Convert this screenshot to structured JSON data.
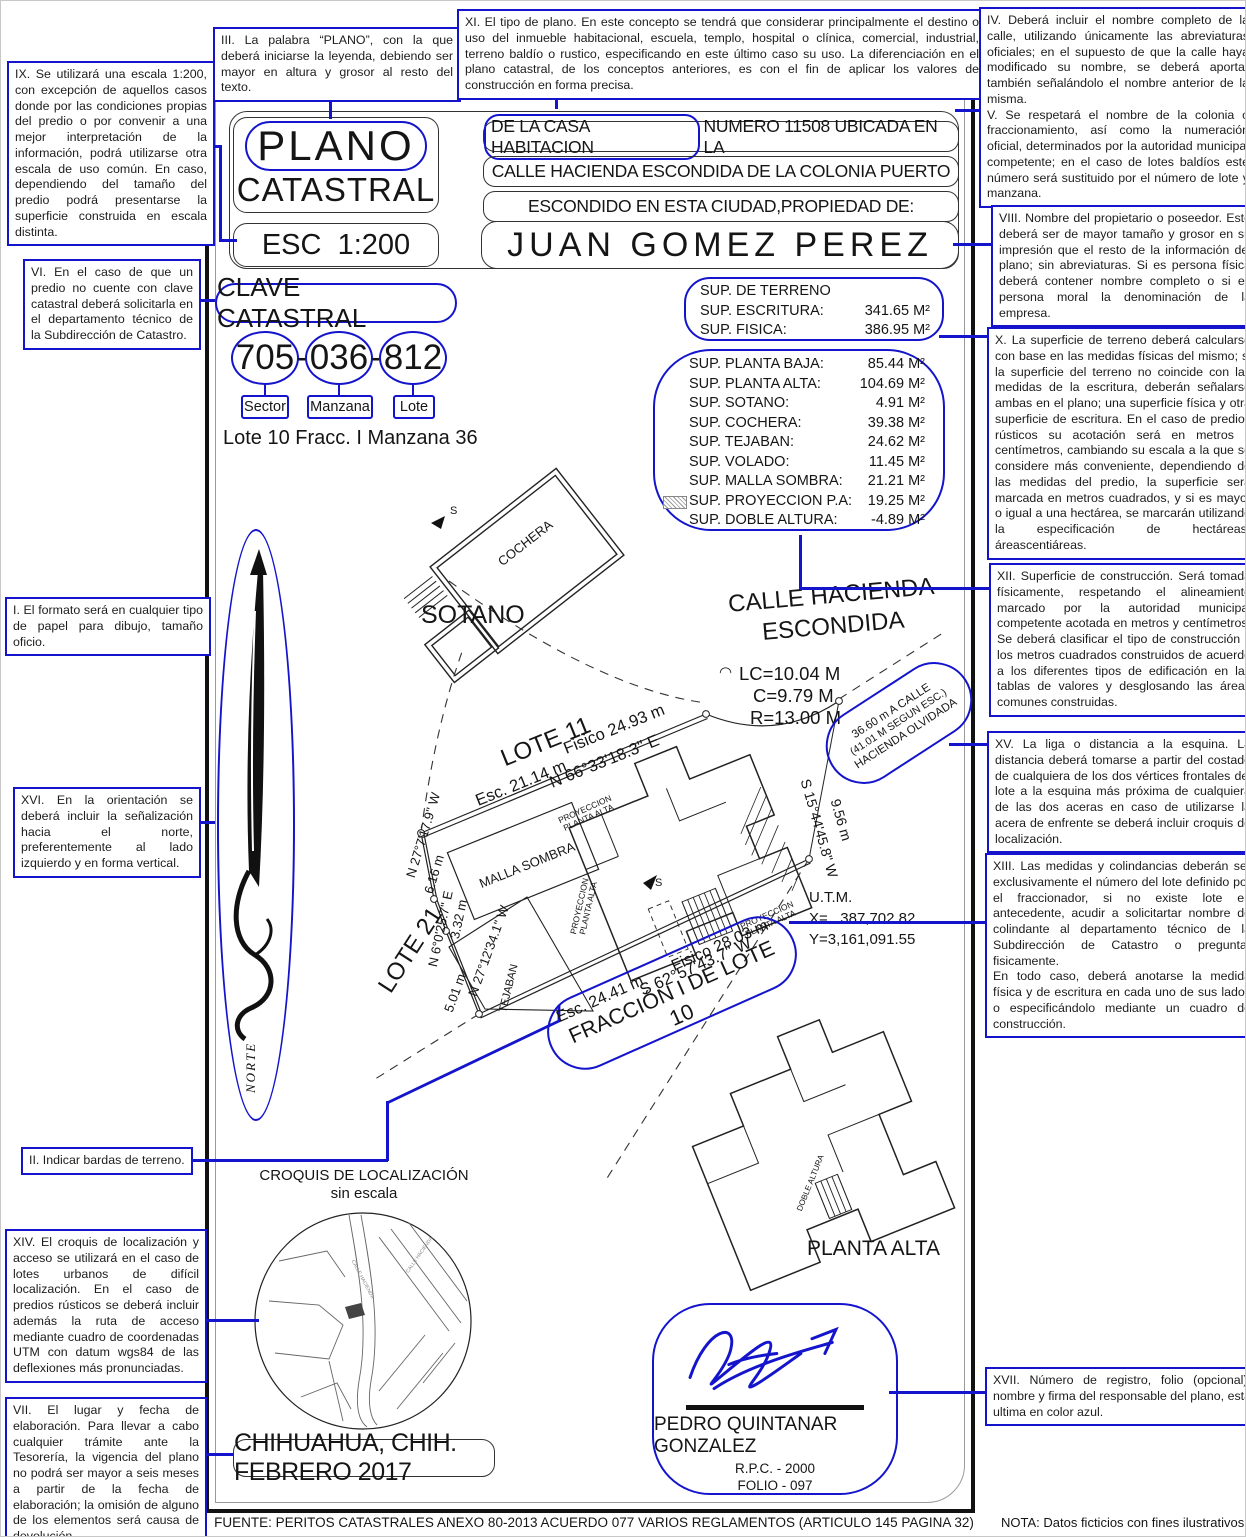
{
  "colors": {
    "annotation_blue": "#1414cc",
    "ink": "#151515"
  },
  "annotations": {
    "ix": "IX. Se utilizará una escala 1:200, con excepción de aquellos casos donde por las condiciones propias del predio o por convenir a una mejor interpretación de la información, podrá utilizarse otra escala de uso común. En caso, dependiendo del tamaño del predio podrá presentarse la superficie construida en escala distinta.",
    "iii": "III. La palabra “PLANO”, con la que deberá iniciarse la leyenda, debiendo ser mayor en altura y grosor al resto del texto.",
    "xi": "XI. El tipo de plano. En este concepto se tendrá que considerar principalmente el destino o uso del inmueble habitacional, escuela, templo, hospital o clínica, comercial, industrial, terreno baldío o rustico, especificando en este último caso su uso. La diferenciación en el plano catastral, de los conceptos anteriores, es con el fin de aplicar los valores de construcción en forma precisa.",
    "iv": "IV. Deberá incluir el nombre completo de la calle, utilizando únicamente las abreviaturas oficiales; en el supuesto de que la calle haya modificado su nombre, se deberá aportar también señalándolo el nombre anterior de la misma.",
    "v": "V. Se respetará el nombre de la colonia o fraccionamiento, así como la numeración oficial, determinados por la autoridad municipal competente; en el caso de lotes baldíos este número será sustituido por el número de lote y manzana.",
    "viii": "VIII. Nombre del propietario o poseedor. Este deberá ser de mayor tamaño y grosor en su impresión que el resto de la información del plano; sin abreviaturas. Si es persona física deberá contener nombre completo o si es persona moral la denominación de la empresa.",
    "x": "X. La superficie de terreno deberá calcularse con base en las medidas físicas del mismo; si la superficie del terreno no coincide con las medidas de la escritura, deberán señalarse ambas en el plano; una superficie física y otra superficie de escritura. En el caso de predios rústicos su acotación será en metros y centímetros, cambiando su escala a la que se considere más conveniente, dependiendo de las medidas del predio, la superficie será marcada en metros cuadrados, y si es mayor o igual a una hectárea, se marcarán utilizando la especificación de hectáreas-áreascentiáreas.",
    "xii": "XII. Superficie de construcción. Será tomada físicamente, respetando el alineamiento marcado por la autoridad municipal competente acotada en metros y centímetros. Se deberá clasificar el tipo de construcción y los metros cuadrados construidos de acuerdo a los diferentes tipos de edificación en las tablas de valores y desglosando las áreas comunes construidas.",
    "xv": "XV. La liga o distancia a la esquina. La distancia deberá tomarse a partir del costado de cualquiera de los dos vértices frontales del lote a la esquina más próxima de cualquiera de las dos aceras en caso de utilizarse la acera de enfrente se deberá incluir croquis de localización.",
    "xiii_p1": "XIII. Las medidas y colindancias deberán ser exclusivamente el número del lote definido por el fraccionador, si no existe lote en antecedente, acudir a solicitartar nombre de colindante al departamento técnico de la Subdirección de Catastro o preguntar fisicamente.",
    "xiii_p2": "En todo caso, deberá anotarse la medida física y de escritura en cada uno de sus lados o especificándolo mediante un cuadro de construcción.",
    "xvii": "XVII. Número de registro, folio (opcional), nombre y firma del responsable del plano, esta ultima en color azul.",
    "vi": "VI. En el caso de que un predio no cuente con clave catastral deberá solicitarla en el departamento técnico de la Subdirección de Catastro.",
    "i": "I. El formato será en cualquier tipo de papel para dibujo, tamaño oficio.",
    "xvi": "XVI. En la orientación se deberá incluir la señalización hacia el norte, preferentemente al lado izquierdo y en forma vertical.",
    "ii": "II. Indicar bardas de terreno.",
    "xiv": "XIV. El croquis de localización y acceso se utilizará en el caso de lotes urbanos de difícil localización. En el caso de predios rústicos se deberá incluir además la ruta de acceso mediante cuadro de coordenadas UTM con datum wgs84 de las deflexiones más pronunciadas.",
    "vii": "VII. El lugar y fecha de elaboración. Para llevar a cabo cualquier trámite ante la Tesorería, la vigencia del plano no podrá ser mayor a seis meses a partir de la fecha de elaboración; la omisión de alguno de los elementos será causa de devolución."
  },
  "title_block": {
    "plano": "PLANO",
    "catastral": "CATASTRAL",
    "esc": "ESC  1:200",
    "owner": "JUAN GOMEZ PEREZ",
    "addr1_hl": "DE LA CASA HABITACION",
    "addr1_rest": "NUMERO 11508 UBICADA EN LA",
    "addr2": "CALLE HACIENDA ESCONDIDA DE LA COLONIA PUERTO",
    "addr3": "ESCONDIDO EN ESTA CIUDAD,PROPIEDAD DE:"
  },
  "clave": {
    "title": "CLAVE CATASTRAL",
    "sector_num": "705",
    "manzana_num": "036",
    "lote_num": "812",
    "dash": "-",
    "sector_label": "Sector",
    "manzana_label": "Manzana",
    "lote_label": "Lote",
    "sub": "Lote 10 Fracc. I Manzana 36"
  },
  "sup_terreno": {
    "title": "SUP. DE TERRENO",
    "rows": [
      {
        "label": "SUP. ESCRITURA:",
        "value": "341.65 M²"
      },
      {
        "label": "SUP. FISICA:",
        "value": "386.95 M²"
      }
    ]
  },
  "sup_construccion": {
    "rows": [
      {
        "label": "SUP. PLANTA BAJA:",
        "value": "85.44 M²"
      },
      {
        "label": "SUP. PLANTA ALTA:",
        "value": "104.69 M²"
      },
      {
        "label": "SUP. SOTANO:",
        "value": "4.91 M²"
      },
      {
        "label": "SUP. COCHERA:",
        "value": "39.38 M²"
      },
      {
        "label": "SUP. TEJABAN:",
        "value": "24.62 M²"
      },
      {
        "label": "SUP. VOLADO:",
        "value": "11.45 M²"
      },
      {
        "label": "SUP. MALLA SOMBRA:",
        "value": "21.21 M²"
      },
      {
        "label": "SUP. PROYECCION P.A:",
        "value": "19.25 M²"
      },
      {
        "label": "SUP. DOBLE ALTURA:",
        "value": "-4.89 M²"
      }
    ]
  },
  "plan": {
    "sotano": "SOTANO",
    "cochera": "COCHERA",
    "calle1": "CALLE HACIENDA",
    "calle2": "ESCONDIDA",
    "arc_glyph": "◠",
    "lc": "LC=10.04 M",
    "c": "C=9.79 M",
    "r": "R=13.00 M",
    "lote11": "LOTE 11",
    "esc_n": "Esc. 21.14 m",
    "fisico_n": "Fisico 24.93 m",
    "bearing_n": "N 66°33'18.3\" E",
    "b1": "N 27°7'17.9\" W",
    "d1": "6.16 m",
    "b2": "N 6°0'25.7\" E",
    "d2": "3.32 m",
    "b3": "N 27°12'34.1\" W",
    "d3": "5.01 m",
    "lote21": "LOTE 21",
    "malla_sombra": "MALLA SOMBRA",
    "tejaban": "TEJABAN",
    "proyeccion1": "PROYECCION",
    "proyeccion2": "PLANTA ALTA",
    "bearing_s": "S 62°57'43.7\" W",
    "esc_s": "Esc. 24.41 m",
    "fisico_s": "Fisico 28.03 m",
    "fraccion": "FRACCIÓN I DE LOTE 10",
    "bearing_e": "S 15°44'45.8\" W",
    "dist_e": "9.56 m",
    "liga1": "36.60 m  A CALLE",
    "liga2": "(41.01 M SEGUN ESC.)",
    "liga3": "HACIENDA OLVIDADA",
    "utm_title": "U.T.M.",
    "utm_x": "X=   387,702.82",
    "utm_y": "Y=3,161,091.55",
    "planta_alta": "PLANTA ALTA",
    "doble_altura": "DOBLE ALTURA",
    "norte": "NORTE",
    "s_label": "S"
  },
  "croquis": {
    "title": "CROQUIS DE LOCALIZACIÓN",
    "subtitle": "sin escala",
    "street1": "CALLE HACIENDA",
    "street2": "CALLE HACIENDA"
  },
  "date_box": "CHIHUAHUA, CHIH. FEBRERO 2017",
  "signature": {
    "name": "PEDRO QUINTANAR GONZALEZ",
    "rpc": "R.P.C. - 2000",
    "folio": "FOLIO - 097"
  },
  "footer": {
    "fuente": "FUENTE: PERITOS CATASTRALES ANEXO 80-2013 ACUERDO 077 VARIOS REGLAMENTOS (ARTICULO 145 PAGINA 32)",
    "nota": "NOTA: Datos ficticios con fines ilustrativos."
  }
}
